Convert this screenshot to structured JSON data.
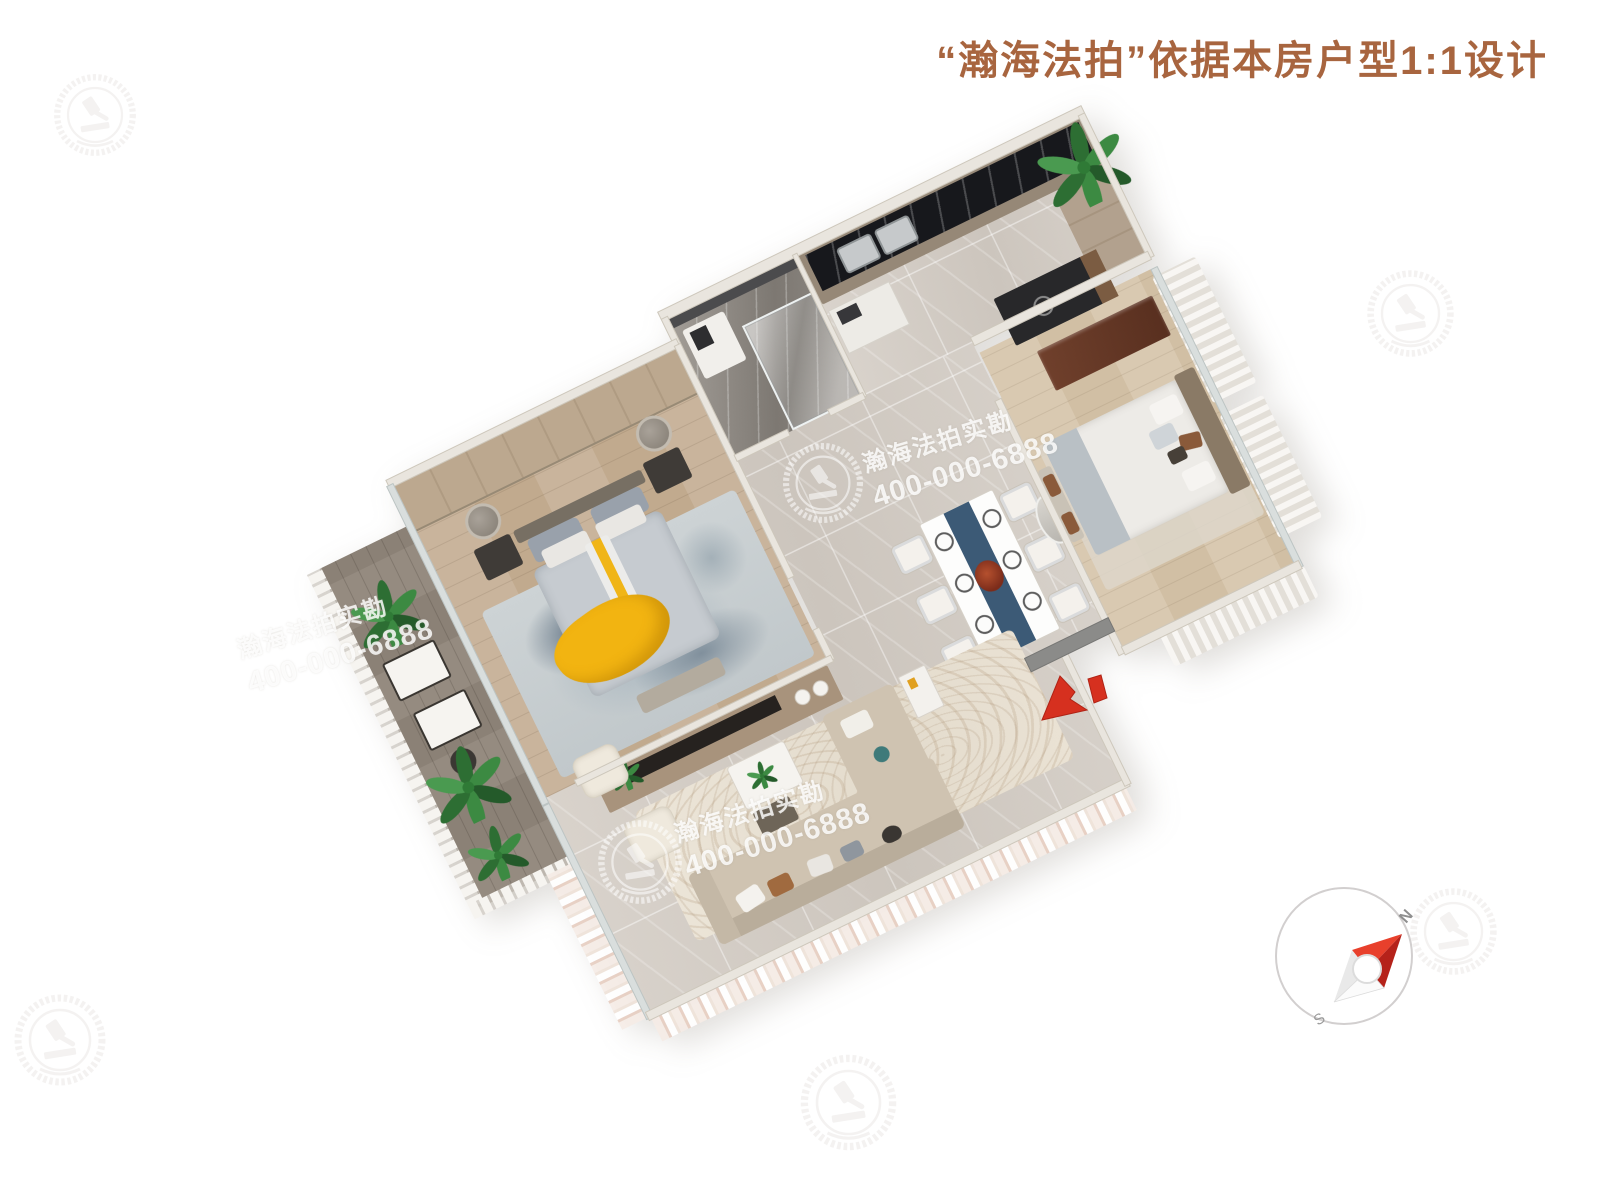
{
  "header": {
    "title": "“瀚海法拍”依据本房户型1:1设计",
    "title_color": "#a8653f"
  },
  "watermarks": {
    "brand": "瀚海法拍实勘",
    "phone": "400-000-6888",
    "logo": "hanhai-laurel-gavel-logo",
    "text_color": "#ffffff"
  },
  "compass": {
    "north": "N",
    "south": "S",
    "needle_red": "#d03024",
    "ring_color": "#d2cfcf"
  },
  "entrance_arrow": {
    "color": "#d6301f"
  },
  "palette": {
    "background": "#ffffff",
    "bed_throw_yellow": "#f0b517",
    "dining_runner_blue": "#3c5a76",
    "plant_green": "#2f7a36",
    "marble_floor": "#d6d0c9",
    "wood_floor": "#c9b49a",
    "dark_counter": "#17181c"
  }
}
